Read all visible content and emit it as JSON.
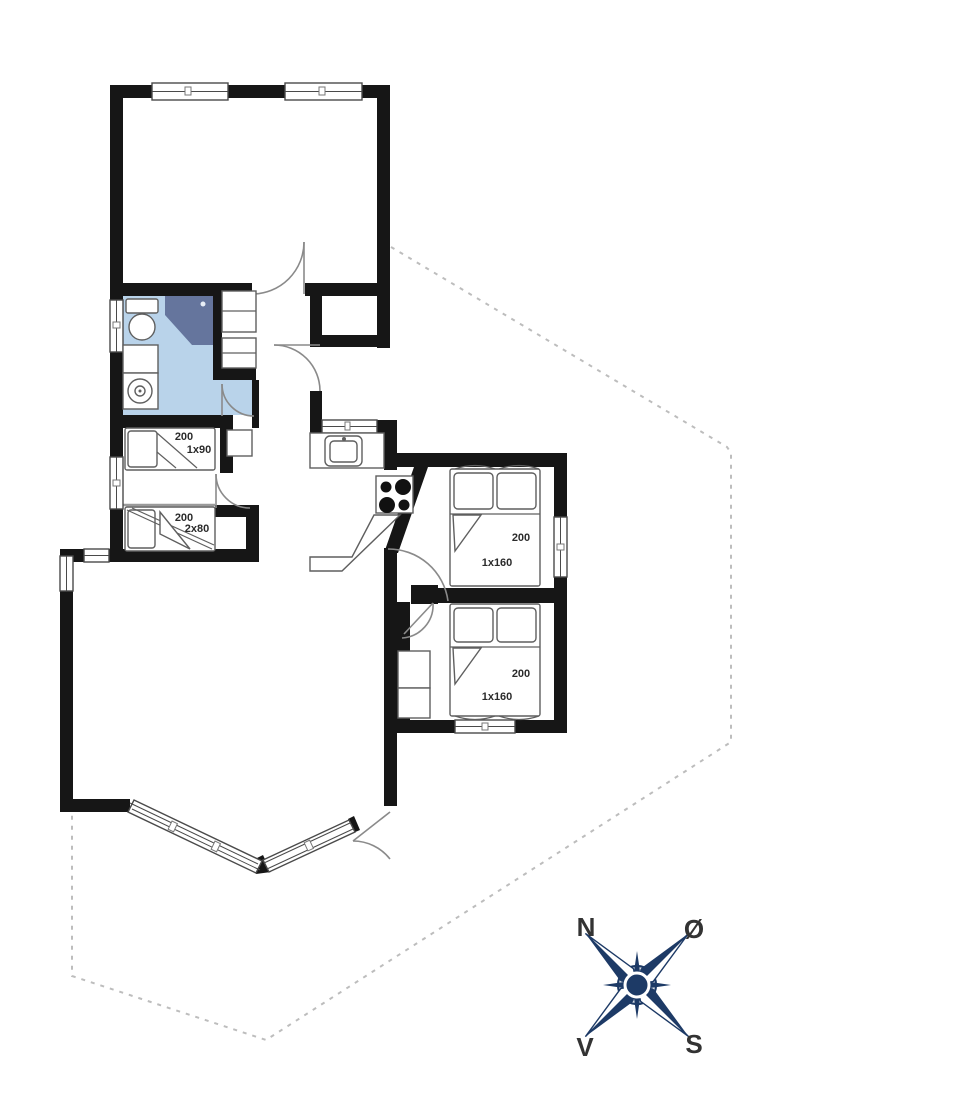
{
  "plan": {
    "type": "holiday-house-floor-plan",
    "beds": {
      "small_room_top": {
        "length": "200",
        "size": "1x90"
      },
      "small_room_bottom": {
        "length": "200",
        "size": "2x80"
      },
      "bedroom_east": {
        "length": "200",
        "size": "1x160"
      },
      "bedroom_south": {
        "length": "200",
        "size": "1x160"
      }
    },
    "compass": {
      "north": "N",
      "east": "Ø",
      "south": "S",
      "west": "V"
    },
    "colors": {
      "wall": "#161616",
      "bathroom_floor": "#b9d3ea",
      "shower": "#65759d",
      "compass_navy": "#1d3a66",
      "plot_boundary": "#bdbdbd"
    }
  }
}
